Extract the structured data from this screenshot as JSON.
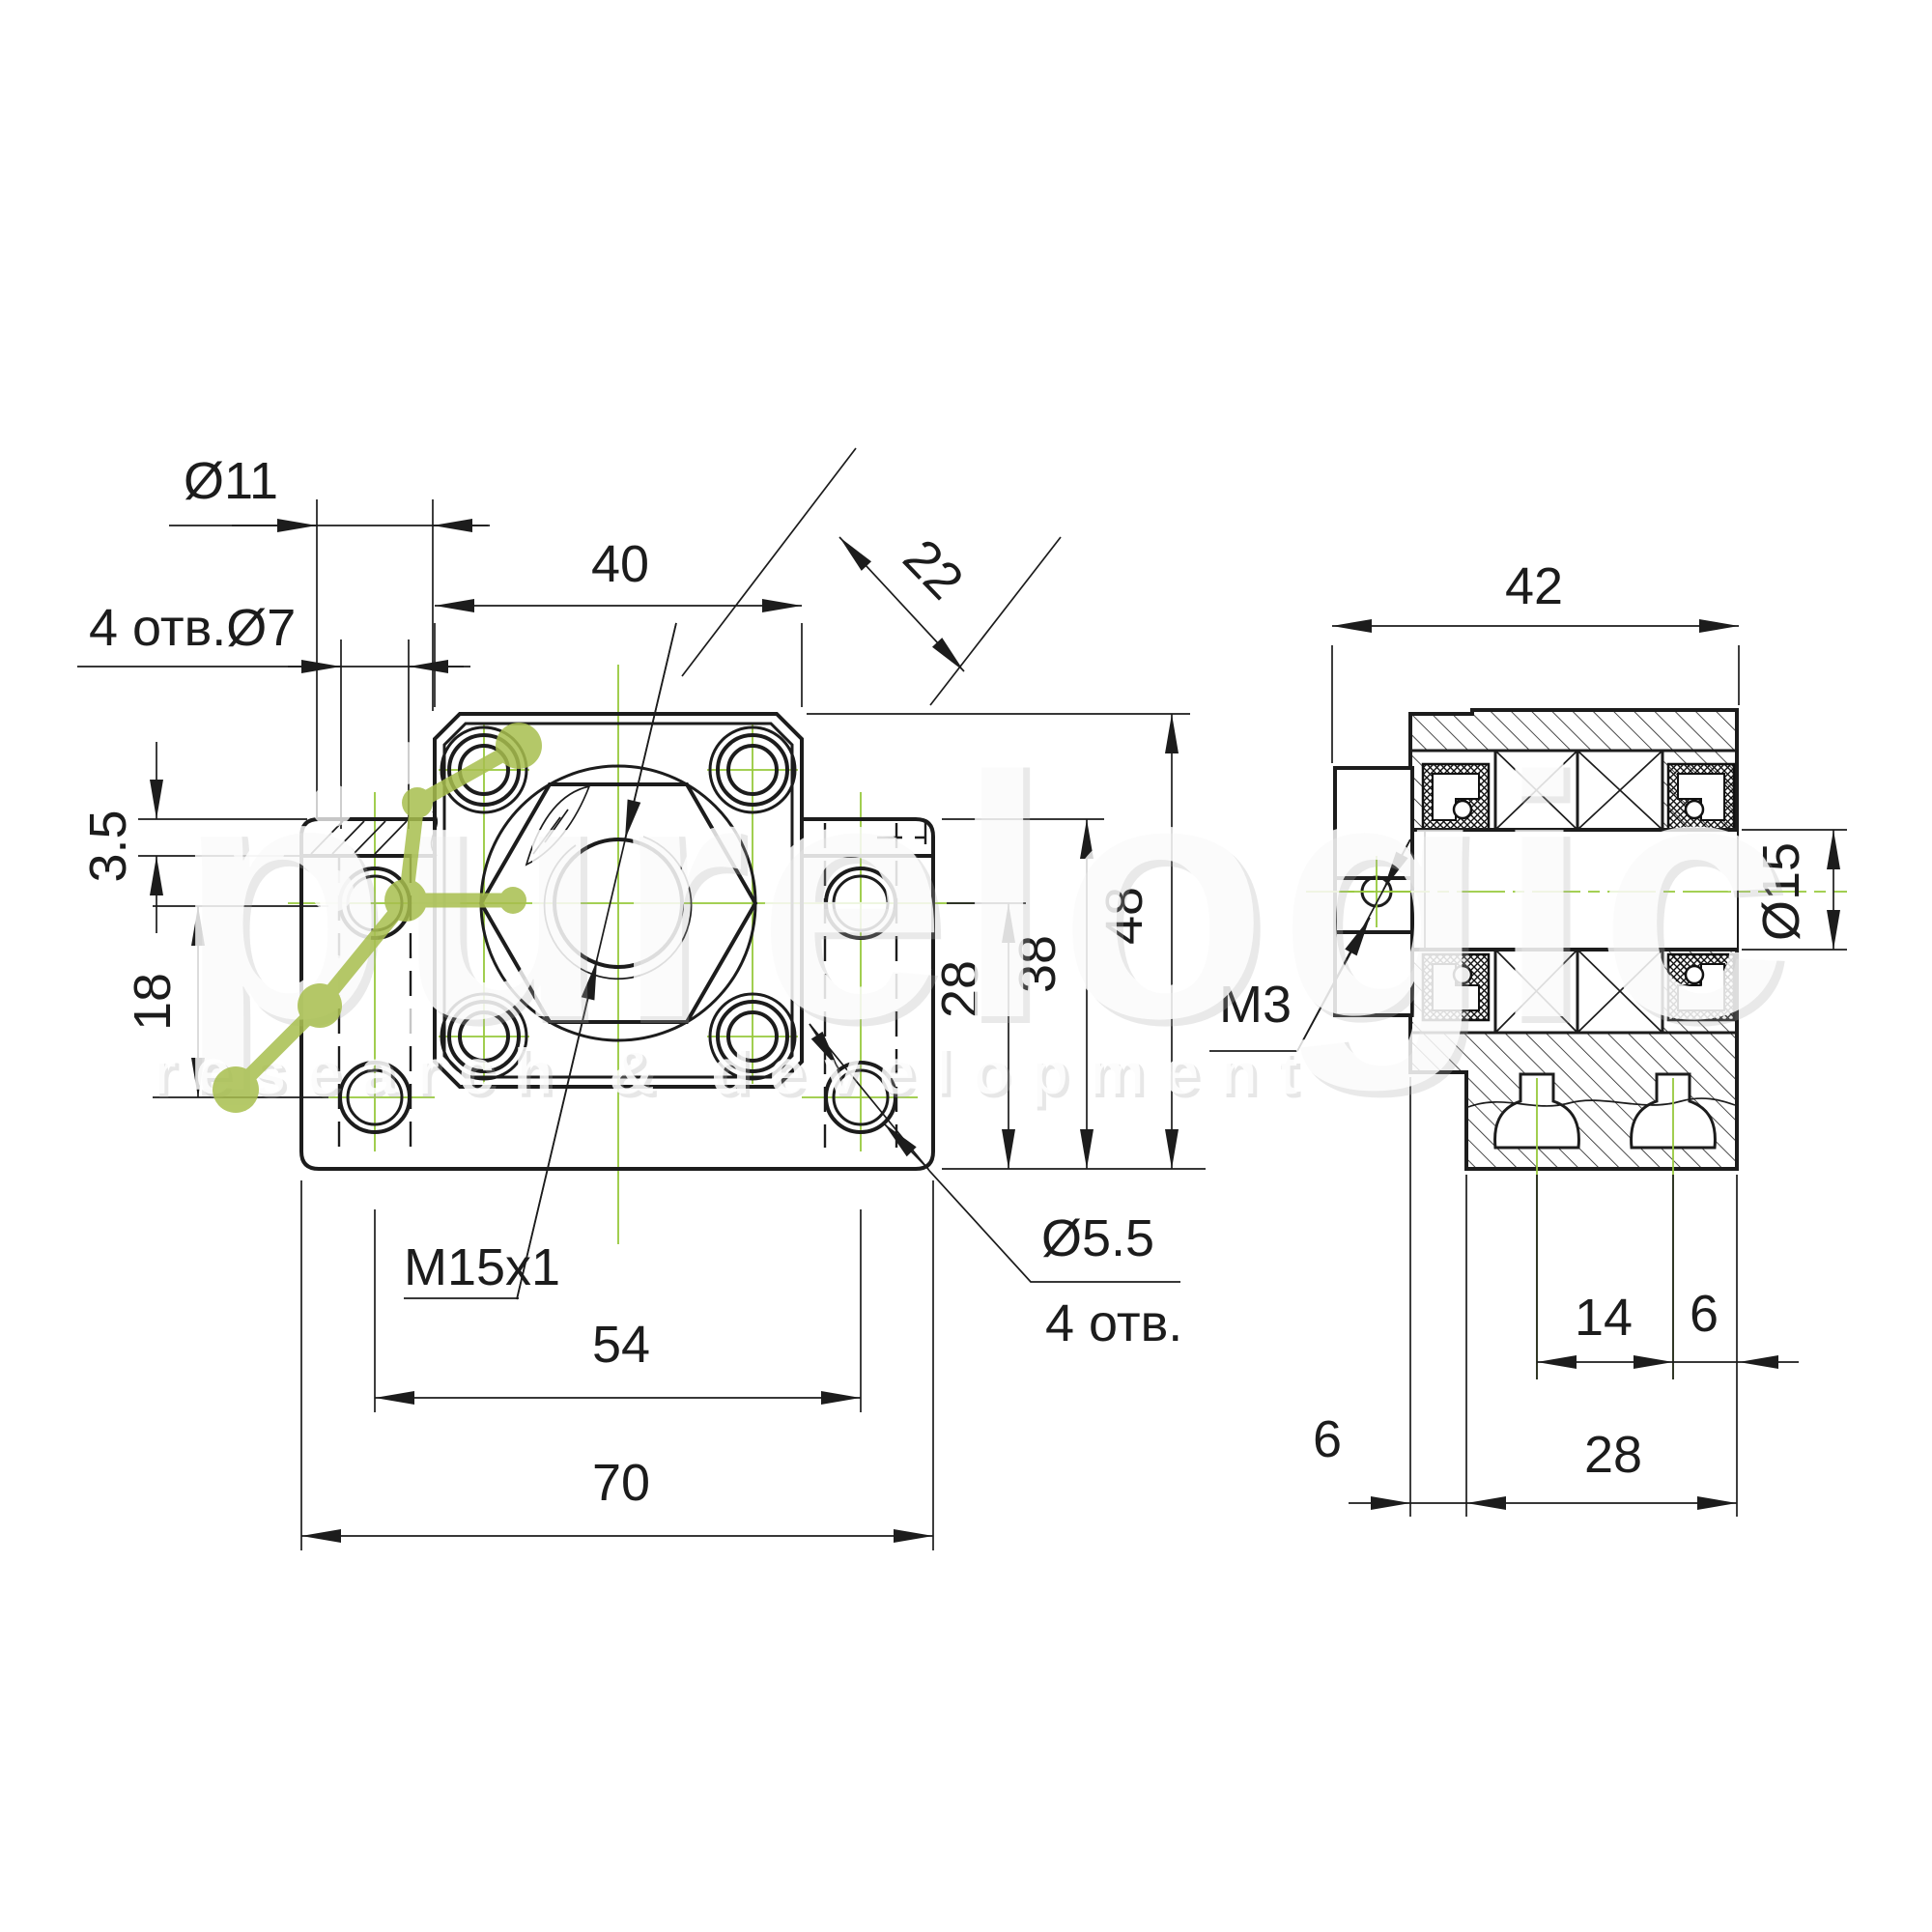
{
  "colors": {
    "line": "#1c1c1c",
    "centerline_green": "#97c93c",
    "logo_green": "#a8bf4e",
    "background": "#ffffff"
  },
  "watermark": {
    "brand": "purelogic",
    "tagline": "research & development"
  },
  "front_view": {
    "dims": {
      "counterbore_dia": "Ø11",
      "base_holes": "4 отв.Ø7",
      "flange_width": "40",
      "flange_hole_diagonal": "22",
      "lip_height": "3.5",
      "base_hole_spacing_vertical": "18",
      "thread": "M15x1",
      "base_hole_spacing_horizontal": "54",
      "base_width": "70",
      "center_height": "28",
      "lip_top_height": "38",
      "body_height": "48",
      "flange_hole_dia": "Ø5.5",
      "flange_hole_count": "4 отв."
    }
  },
  "side_view": {
    "dims": {
      "body_width": "42",
      "shaft_dia": "Ø15",
      "set_screw_thread": "M3",
      "slot_spacing": "14",
      "slot_to_edge": "6",
      "foot_offset": "6",
      "foot_width": "28"
    }
  }
}
